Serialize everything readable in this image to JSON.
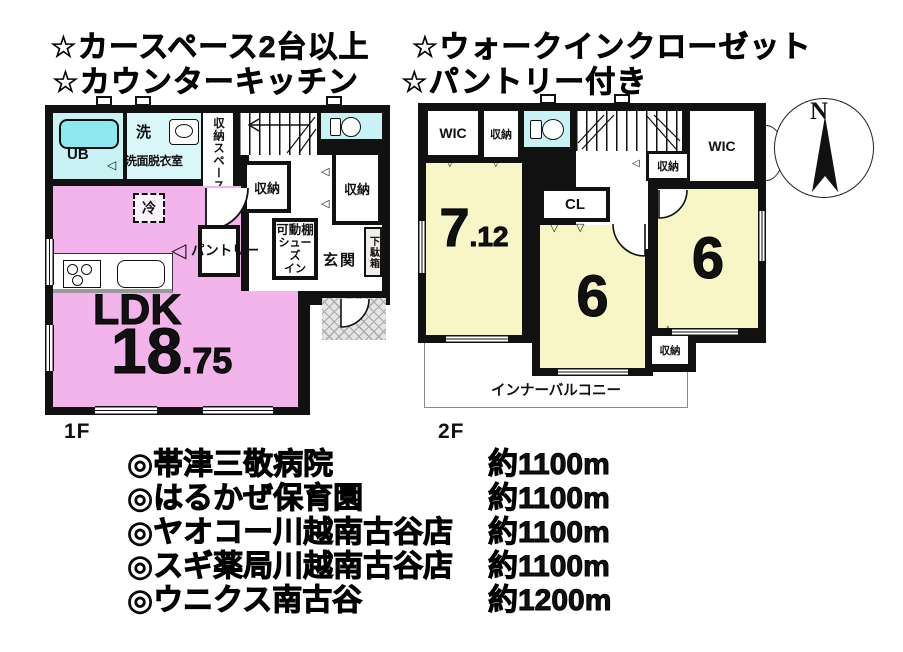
{
  "header": {
    "line1a": "☆カースペース2台以上",
    "line1b": "☆ウォークインクローゼット",
    "line2a": "☆カウンターキッチン",
    "line2b": "☆パントリー付き"
  },
  "floor1": {
    "label": "1F",
    "rooms": {
      "ub": "UB",
      "wash_short": "洗",
      "wash": "洗面脱衣室",
      "storage_space": "収納スペース",
      "storage_a": "収納",
      "storage_b": "収納",
      "fridge": "冷",
      "pantry": "パントリー",
      "movable_shelf": "可動棚",
      "shoes_line1": "シューズ",
      "shoes_line2": "イン",
      "entrance": "玄関",
      "shoe_cabinet": "下駄箱",
      "ldk": "LDK",
      "area_int": "18",
      "area_dec": ".75"
    }
  },
  "floor2": {
    "label": "2F",
    "rooms": {
      "wic_left": "WIC",
      "wic_right": "WIC",
      "storage_top": "収納",
      "storage_mid": "収納",
      "storage_bottom": "収納",
      "closet": "CL",
      "room1_int": "7",
      "room1_dec": ".12",
      "room2": "6",
      "room3": "6",
      "balcony": "インナーバルコニー"
    }
  },
  "compass": {
    "north": "N"
  },
  "icons": {
    "door_left": "◁",
    "door_down": "▽",
    "door_up": "△"
  },
  "facilities": {
    "marker": "◎",
    "items": [
      {
        "name": "帯津三敬病院",
        "distance": "約1100m"
      },
      {
        "name": "はるかぜ保育園",
        "distance": "約1100m"
      },
      {
        "name": "ヤオコー川越南古谷店",
        "distance": "約1100m"
      },
      {
        "name": "スギ薬局川越南古谷店",
        "distance": "約1100m"
      },
      {
        "name": "ウニクス南古谷",
        "distance": "約1200m"
      }
    ]
  },
  "colors": {
    "wall": "#111111",
    "ldk_pink": "#f2b4ea",
    "room_yellow": "#f8f5c6",
    "bath_cyan": "#c9f2f5",
    "bath_cyan_light": "#d9f7f9",
    "fixture_cyan": "#8de8ef"
  }
}
